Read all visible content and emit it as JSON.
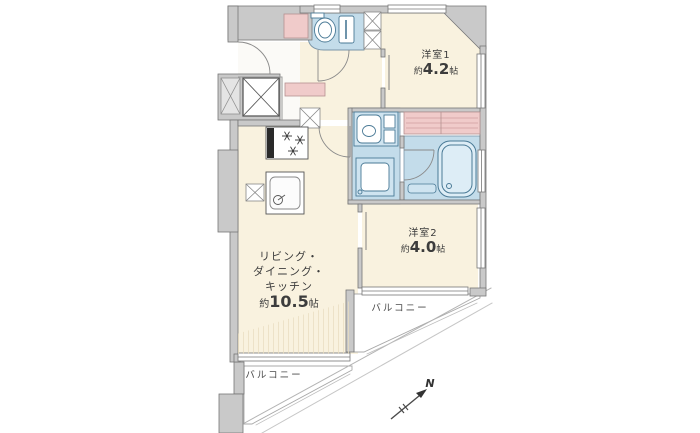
{
  "floor_plan": {
    "rooms": {
      "western_room_1": {
        "name": "洋室1",
        "area_prefix": "約",
        "area_value": "4.2",
        "area_unit": "帖"
      },
      "western_room_2": {
        "name": "洋室2",
        "area_prefix": "約",
        "area_value": "4.0",
        "area_unit": "帖"
      },
      "ldk": {
        "name_line_1": "リビング・",
        "name_line_2": "ダイニング・",
        "name_line_3": "キッチン",
        "area_prefix": "約",
        "area_value": "10.5",
        "area_unit": "帖"
      },
      "balcony_upper": {
        "name": "バルコニー"
      },
      "balcony_lower": {
        "name": "バルコニー"
      }
    },
    "compass": {
      "north_label": "N"
    },
    "colors": {
      "room_fill": "#f9f2df",
      "wet_area_fill": "#c3dcea",
      "closet_fill": "#f0cbca",
      "wall_fill": "#c9c9c9",
      "fixture_stroke": "#4a7a96",
      "outline": "#767676"
    }
  }
}
